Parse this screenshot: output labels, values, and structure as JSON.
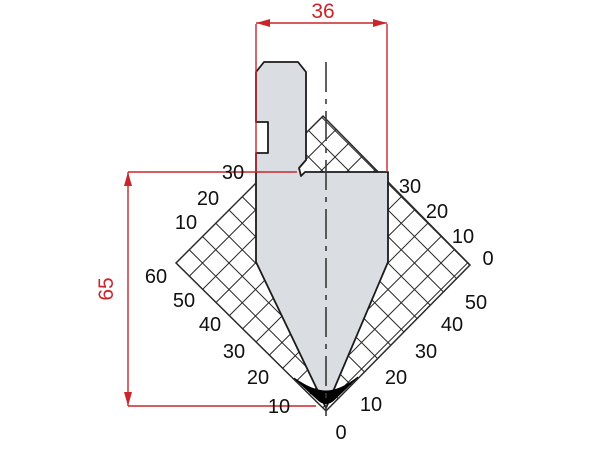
{
  "drawing": {
    "type_label": "press-brake-punch-section",
    "dimensions": {
      "width": "36",
      "height": "65"
    },
    "scales": {
      "left_upper": [
        "30",
        "20",
        "10"
      ],
      "left_corner": "60",
      "left_lower": [
        "50",
        "40",
        "30",
        "20",
        "10"
      ],
      "right_upper": [
        "30",
        "20",
        "10",
        "0"
      ],
      "right_lower": [
        "50",
        "40",
        "30",
        "20",
        "10"
      ],
      "bottom_zero": "0"
    },
    "colors": {
      "dimension": "#c8262c",
      "body_fill": "#dadde2",
      "line": "#1b1b1b",
      "hatch": "#2a2a2a"
    }
  }
}
